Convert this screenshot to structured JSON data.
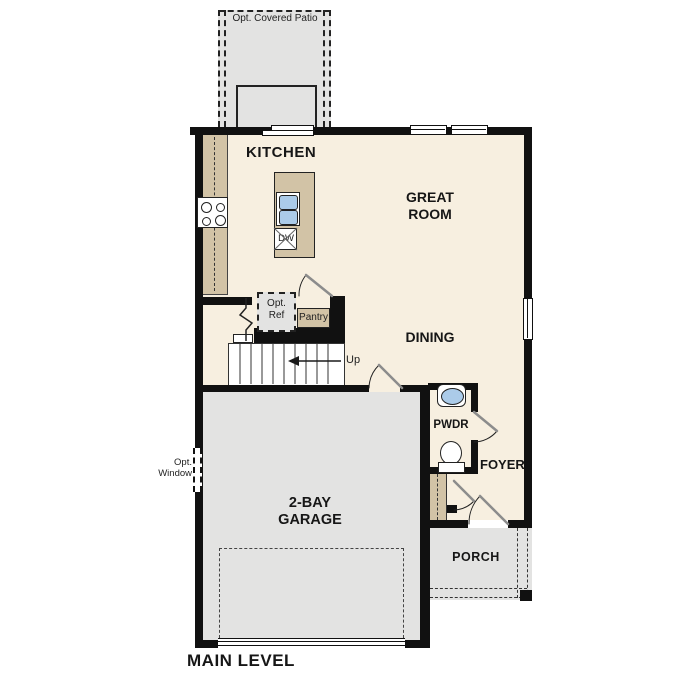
{
  "plan": {
    "title": "MAIN LEVEL",
    "labels": {
      "patio": "Opt. Covered Patio",
      "kitchen": "KITCHEN",
      "great_room": "GREAT ROOM",
      "dining": "DINING",
      "opt_ref": "Opt. Ref",
      "pantry": "Pantry",
      "up": "Up",
      "dw": "DW",
      "pwdr": "PWDR",
      "foyer": "FOYER",
      "garage": "2-BAY GARAGE",
      "porch": "PORCH",
      "opt_window": "Opt. Window"
    }
  },
  "colors": {
    "floor": "#f7efe0",
    "concrete": "#e3e3e2",
    "counter": "#d2c3a6",
    "fixture_blue": "#abcbe9",
    "wall": "#111111",
    "door_leaf": "#8c8c8c"
  }
}
